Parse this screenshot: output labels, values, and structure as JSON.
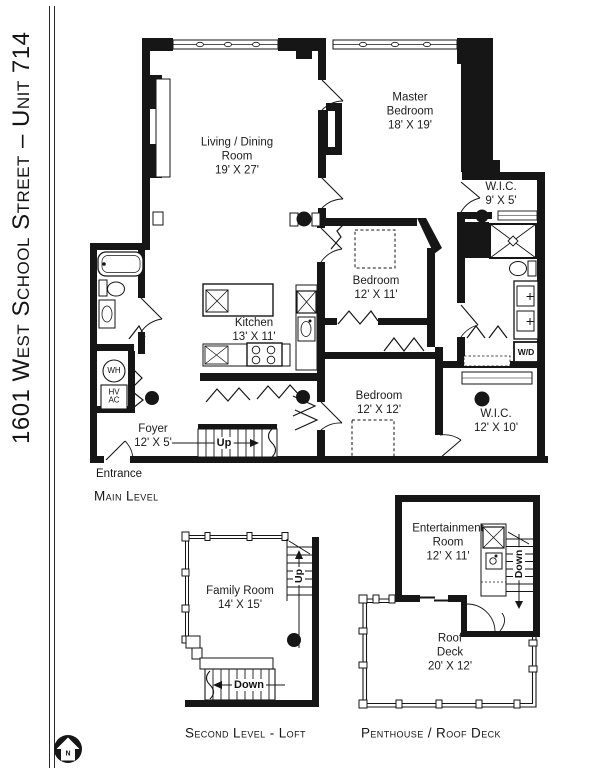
{
  "title": {
    "text": "1601 West School Street – Unit 714"
  },
  "compass": {
    "north": "N"
  },
  "main_level": {
    "caption": "Main Level",
    "entrance": "Entrance",
    "stairs_up": "Up",
    "water_heater": "WH",
    "hvac": "HV AC",
    "washer_dryer": "W/D",
    "rooms": {
      "living_dining": {
        "name": "Living / Dining Room",
        "dims": "19' X 27'"
      },
      "master_bedroom": {
        "name": "Master Bedroom",
        "dims": "18' X 19'"
      },
      "master_wic": {
        "name": "W.I.C.",
        "dims": "9' X 5'"
      },
      "bedroom_one": {
        "name": "Bedroom",
        "dims": "12' X 11'"
      },
      "kitchen": {
        "name": "Kitchen",
        "dims": "13' X 11'"
      },
      "bedroom_two": {
        "name": "Bedroom",
        "dims": "12' X 12'"
      },
      "walk_in_closet": {
        "name": "W.I.C.",
        "dims": "12' X 10'"
      },
      "foyer": {
        "name": "Foyer",
        "dims": "12' X 5'"
      }
    }
  },
  "second_level": {
    "caption": "Second Level - Loft",
    "stairs_up": "Up",
    "stairs_down": "Down",
    "rooms": {
      "family_room": {
        "name": "Family Room",
        "dims": "14' X 15'"
      }
    }
  },
  "penthouse": {
    "caption": "Penthouse / Roof Deck",
    "stairs_down": "Down",
    "rooms": {
      "entertainment": {
        "name": "Entertainment Room",
        "dims": "12' X 11'"
      },
      "roof_deck": {
        "name": "Roof Deck",
        "dims": "20' X 12'"
      }
    }
  },
  "colors": {
    "ink": "#161616",
    "background": "#ffffff"
  }
}
